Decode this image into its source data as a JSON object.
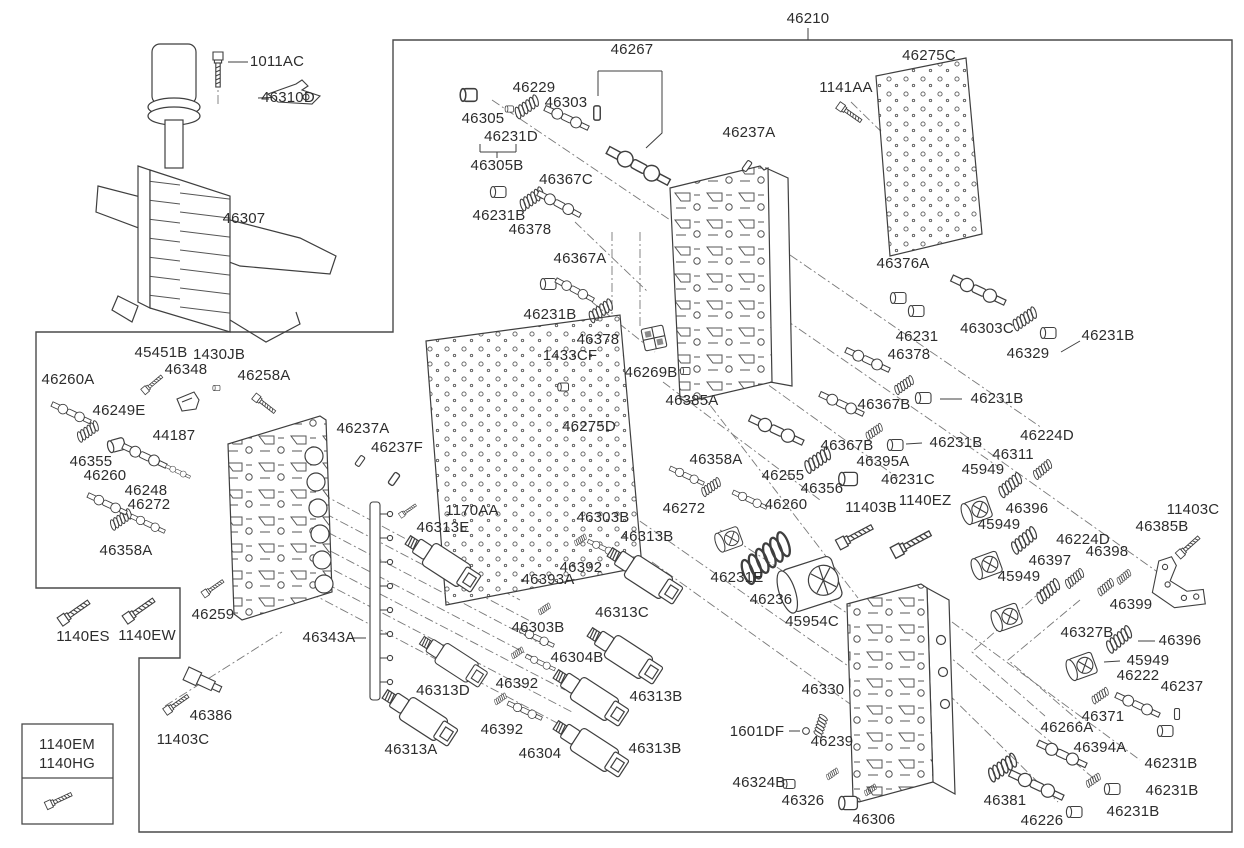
{
  "diagram": {
    "type": "exploded-parts-diagram",
    "subject": "automatic transmission valve body assembly",
    "colors": {
      "background": "#ffffff",
      "line": "#3f3f3f",
      "dash_line": "#787878",
      "text": "#2d2d2d"
    },
    "main_assembly_label": "46210",
    "inset_reference_labels": [
      "1140EM",
      "1140HG"
    ],
    "labels": [
      {
        "text": "1011AC",
        "x": 277,
        "y": 62
      },
      {
        "text": "46310D",
        "x": 288,
        "y": 98
      },
      {
        "text": "46307",
        "x": 244,
        "y": 219
      },
      {
        "text": "46210",
        "x": 808,
        "y": 19
      },
      {
        "text": "46267",
        "x": 632,
        "y": 50
      },
      {
        "text": "46229",
        "x": 534,
        "y": 88
      },
      {
        "text": "46303",
        "x": 566,
        "y": 103
      },
      {
        "text": "46305",
        "x": 483,
        "y": 119
      },
      {
        "text": "46231D",
        "x": 511,
        "y": 137
      },
      {
        "text": "46305B",
        "x": 497,
        "y": 166
      },
      {
        "text": "46275C",
        "x": 929,
        "y": 56
      },
      {
        "text": "1141AA",
        "x": 846,
        "y": 88
      },
      {
        "text": "46237A",
        "x": 749,
        "y": 133
      },
      {
        "text": "46367C",
        "x": 566,
        "y": 180
      },
      {
        "text": "46231B",
        "x": 499,
        "y": 216
      },
      {
        "text": "46378",
        "x": 530,
        "y": 230
      },
      {
        "text": "46367A",
        "x": 580,
        "y": 259
      },
      {
        "text": "46231B",
        "x": 550,
        "y": 315
      },
      {
        "text": "46378",
        "x": 598,
        "y": 340
      },
      {
        "text": "1433CF",
        "x": 570,
        "y": 356
      },
      {
        "text": "46269B",
        "x": 651,
        "y": 373
      },
      {
        "text": "46385A",
        "x": 692,
        "y": 401
      },
      {
        "text": "46275D",
        "x": 589,
        "y": 427
      },
      {
        "text": "46376A",
        "x": 903,
        "y": 264
      },
      {
        "text": "46231",
        "x": 917,
        "y": 337
      },
      {
        "text": "46303C",
        "x": 987,
        "y": 329
      },
      {
        "text": "46329",
        "x": 1028,
        "y": 354
      },
      {
        "text": "46231B",
        "x": 1108,
        "y": 336
      },
      {
        "text": "46378",
        "x": 909,
        "y": 355
      },
      {
        "text": "46367B",
        "x": 884,
        "y": 405
      },
      {
        "text": "46231B",
        "x": 997,
        "y": 399
      },
      {
        "text": "46367B",
        "x": 847,
        "y": 446
      },
      {
        "text": "46231B",
        "x": 956,
        "y": 443
      },
      {
        "text": "46395A",
        "x": 883,
        "y": 462
      },
      {
        "text": "46231C",
        "x": 908,
        "y": 480
      },
      {
        "text": "46255",
        "x": 783,
        "y": 476
      },
      {
        "text": "46356",
        "x": 822,
        "y": 489
      },
      {
        "text": "46358A",
        "x": 716,
        "y": 460
      },
      {
        "text": "46272",
        "x": 684,
        "y": 509
      },
      {
        "text": "46260",
        "x": 786,
        "y": 505
      },
      {
        "text": "46224D",
        "x": 1047,
        "y": 436
      },
      {
        "text": "46311",
        "x": 1013,
        "y": 455
      },
      {
        "text": "45949",
        "x": 983,
        "y": 470
      },
      {
        "text": "45949",
        "x": 999,
        "y": 525
      },
      {
        "text": "46396",
        "x": 1027,
        "y": 509
      },
      {
        "text": "45949",
        "x": 1019,
        "y": 577
      },
      {
        "text": "46397",
        "x": 1050,
        "y": 561
      },
      {
        "text": "46224D",
        "x": 1083,
        "y": 540
      },
      {
        "text": "46398",
        "x": 1107,
        "y": 552
      },
      {
        "text": "46385B",
        "x": 1162,
        "y": 527
      },
      {
        "text": "11403C",
        "x": 1193,
        "y": 510
      },
      {
        "text": "46399",
        "x": 1131,
        "y": 605
      },
      {
        "text": "46327B",
        "x": 1087,
        "y": 633
      },
      {
        "text": "46396",
        "x": 1180,
        "y": 641
      },
      {
        "text": "45949",
        "x": 1148,
        "y": 661
      },
      {
        "text": "46222",
        "x": 1138,
        "y": 676
      },
      {
        "text": "46237",
        "x": 1182,
        "y": 687
      },
      {
        "text": "46371",
        "x": 1103,
        "y": 717
      },
      {
        "text": "46266A",
        "x": 1067,
        "y": 728
      },
      {
        "text": "46394A",
        "x": 1100,
        "y": 748
      },
      {
        "text": "46231B",
        "x": 1171,
        "y": 764
      },
      {
        "text": "46231B",
        "x": 1172,
        "y": 791
      },
      {
        "text": "46231B",
        "x": 1133,
        "y": 812
      },
      {
        "text": "46226",
        "x": 1042,
        "y": 821
      },
      {
        "text": "46381",
        "x": 1005,
        "y": 801
      },
      {
        "text": "46306",
        "x": 874,
        "y": 820
      },
      {
        "text": "46326",
        "x": 803,
        "y": 801
      },
      {
        "text": "46324B",
        "x": 759,
        "y": 783
      },
      {
        "text": "46239",
        "x": 832,
        "y": 742
      },
      {
        "text": "1601DF",
        "x": 757,
        "y": 732
      },
      {
        "text": "46330",
        "x": 823,
        "y": 690
      },
      {
        "text": "45954C",
        "x": 812,
        "y": 622
      },
      {
        "text": "46236",
        "x": 771,
        "y": 600
      },
      {
        "text": "46231E",
        "x": 737,
        "y": 578
      },
      {
        "text": "11403B",
        "x": 871,
        "y": 508
      },
      {
        "text": "1140EZ",
        "x": 925,
        "y": 501
      },
      {
        "text": "46237A",
        "x": 363,
        "y": 429
      },
      {
        "text": "46237F",
        "x": 397,
        "y": 448
      },
      {
        "text": "1170AA",
        "x": 472,
        "y": 511
      },
      {
        "text": "46313E",
        "x": 443,
        "y": 528
      },
      {
        "text": "46303B",
        "x": 603,
        "y": 518
      },
      {
        "text": "46313B",
        "x": 647,
        "y": 537
      },
      {
        "text": "46392",
        "x": 581,
        "y": 568
      },
      {
        "text": "46393A",
        "x": 548,
        "y": 580
      },
      {
        "text": "46313C",
        "x": 622,
        "y": 613
      },
      {
        "text": "46303B",
        "x": 538,
        "y": 628
      },
      {
        "text": "46304B",
        "x": 577,
        "y": 658
      },
      {
        "text": "46392",
        "x": 517,
        "y": 684
      },
      {
        "text": "46313D",
        "x": 443,
        "y": 691
      },
      {
        "text": "46343A",
        "x": 329,
        "y": 638
      },
      {
        "text": "46313B",
        "x": 656,
        "y": 697
      },
      {
        "text": "46392",
        "x": 502,
        "y": 730
      },
      {
        "text": "46313A",
        "x": 411,
        "y": 750
      },
      {
        "text": "46304",
        "x": 540,
        "y": 754
      },
      {
        "text": "46313B",
        "x": 655,
        "y": 749
      },
      {
        "text": "46259",
        "x": 213,
        "y": 615
      },
      {
        "text": "1140ES",
        "x": 83,
        "y": 637
      },
      {
        "text": "1140EW",
        "x": 147,
        "y": 636
      },
      {
        "text": "46386",
        "x": 211,
        "y": 716
      },
      {
        "text": "11403C",
        "x": 183,
        "y": 740
      },
      {
        "text": "46260A",
        "x": 68,
        "y": 380
      },
      {
        "text": "45451B",
        "x": 161,
        "y": 353
      },
      {
        "text": "46348",
        "x": 186,
        "y": 370
      },
      {
        "text": "1430JB",
        "x": 219,
        "y": 355
      },
      {
        "text": "46258A",
        "x": 264,
        "y": 376
      },
      {
        "text": "46249E",
        "x": 119,
        "y": 411
      },
      {
        "text": "44187",
        "x": 174,
        "y": 436
      },
      {
        "text": "46355",
        "x": 91,
        "y": 462
      },
      {
        "text": "46260",
        "x": 105,
        "y": 476
      },
      {
        "text": "46248",
        "x": 146,
        "y": 491
      },
      {
        "text": "46272",
        "x": 149,
        "y": 505
      },
      {
        "text": "46358A",
        "x": 126,
        "y": 551
      },
      {
        "text": "1140EM",
        "x": 67,
        "y": 745
      },
      {
        "text": "1140HG",
        "x": 67,
        "y": 764
      }
    ]
  }
}
